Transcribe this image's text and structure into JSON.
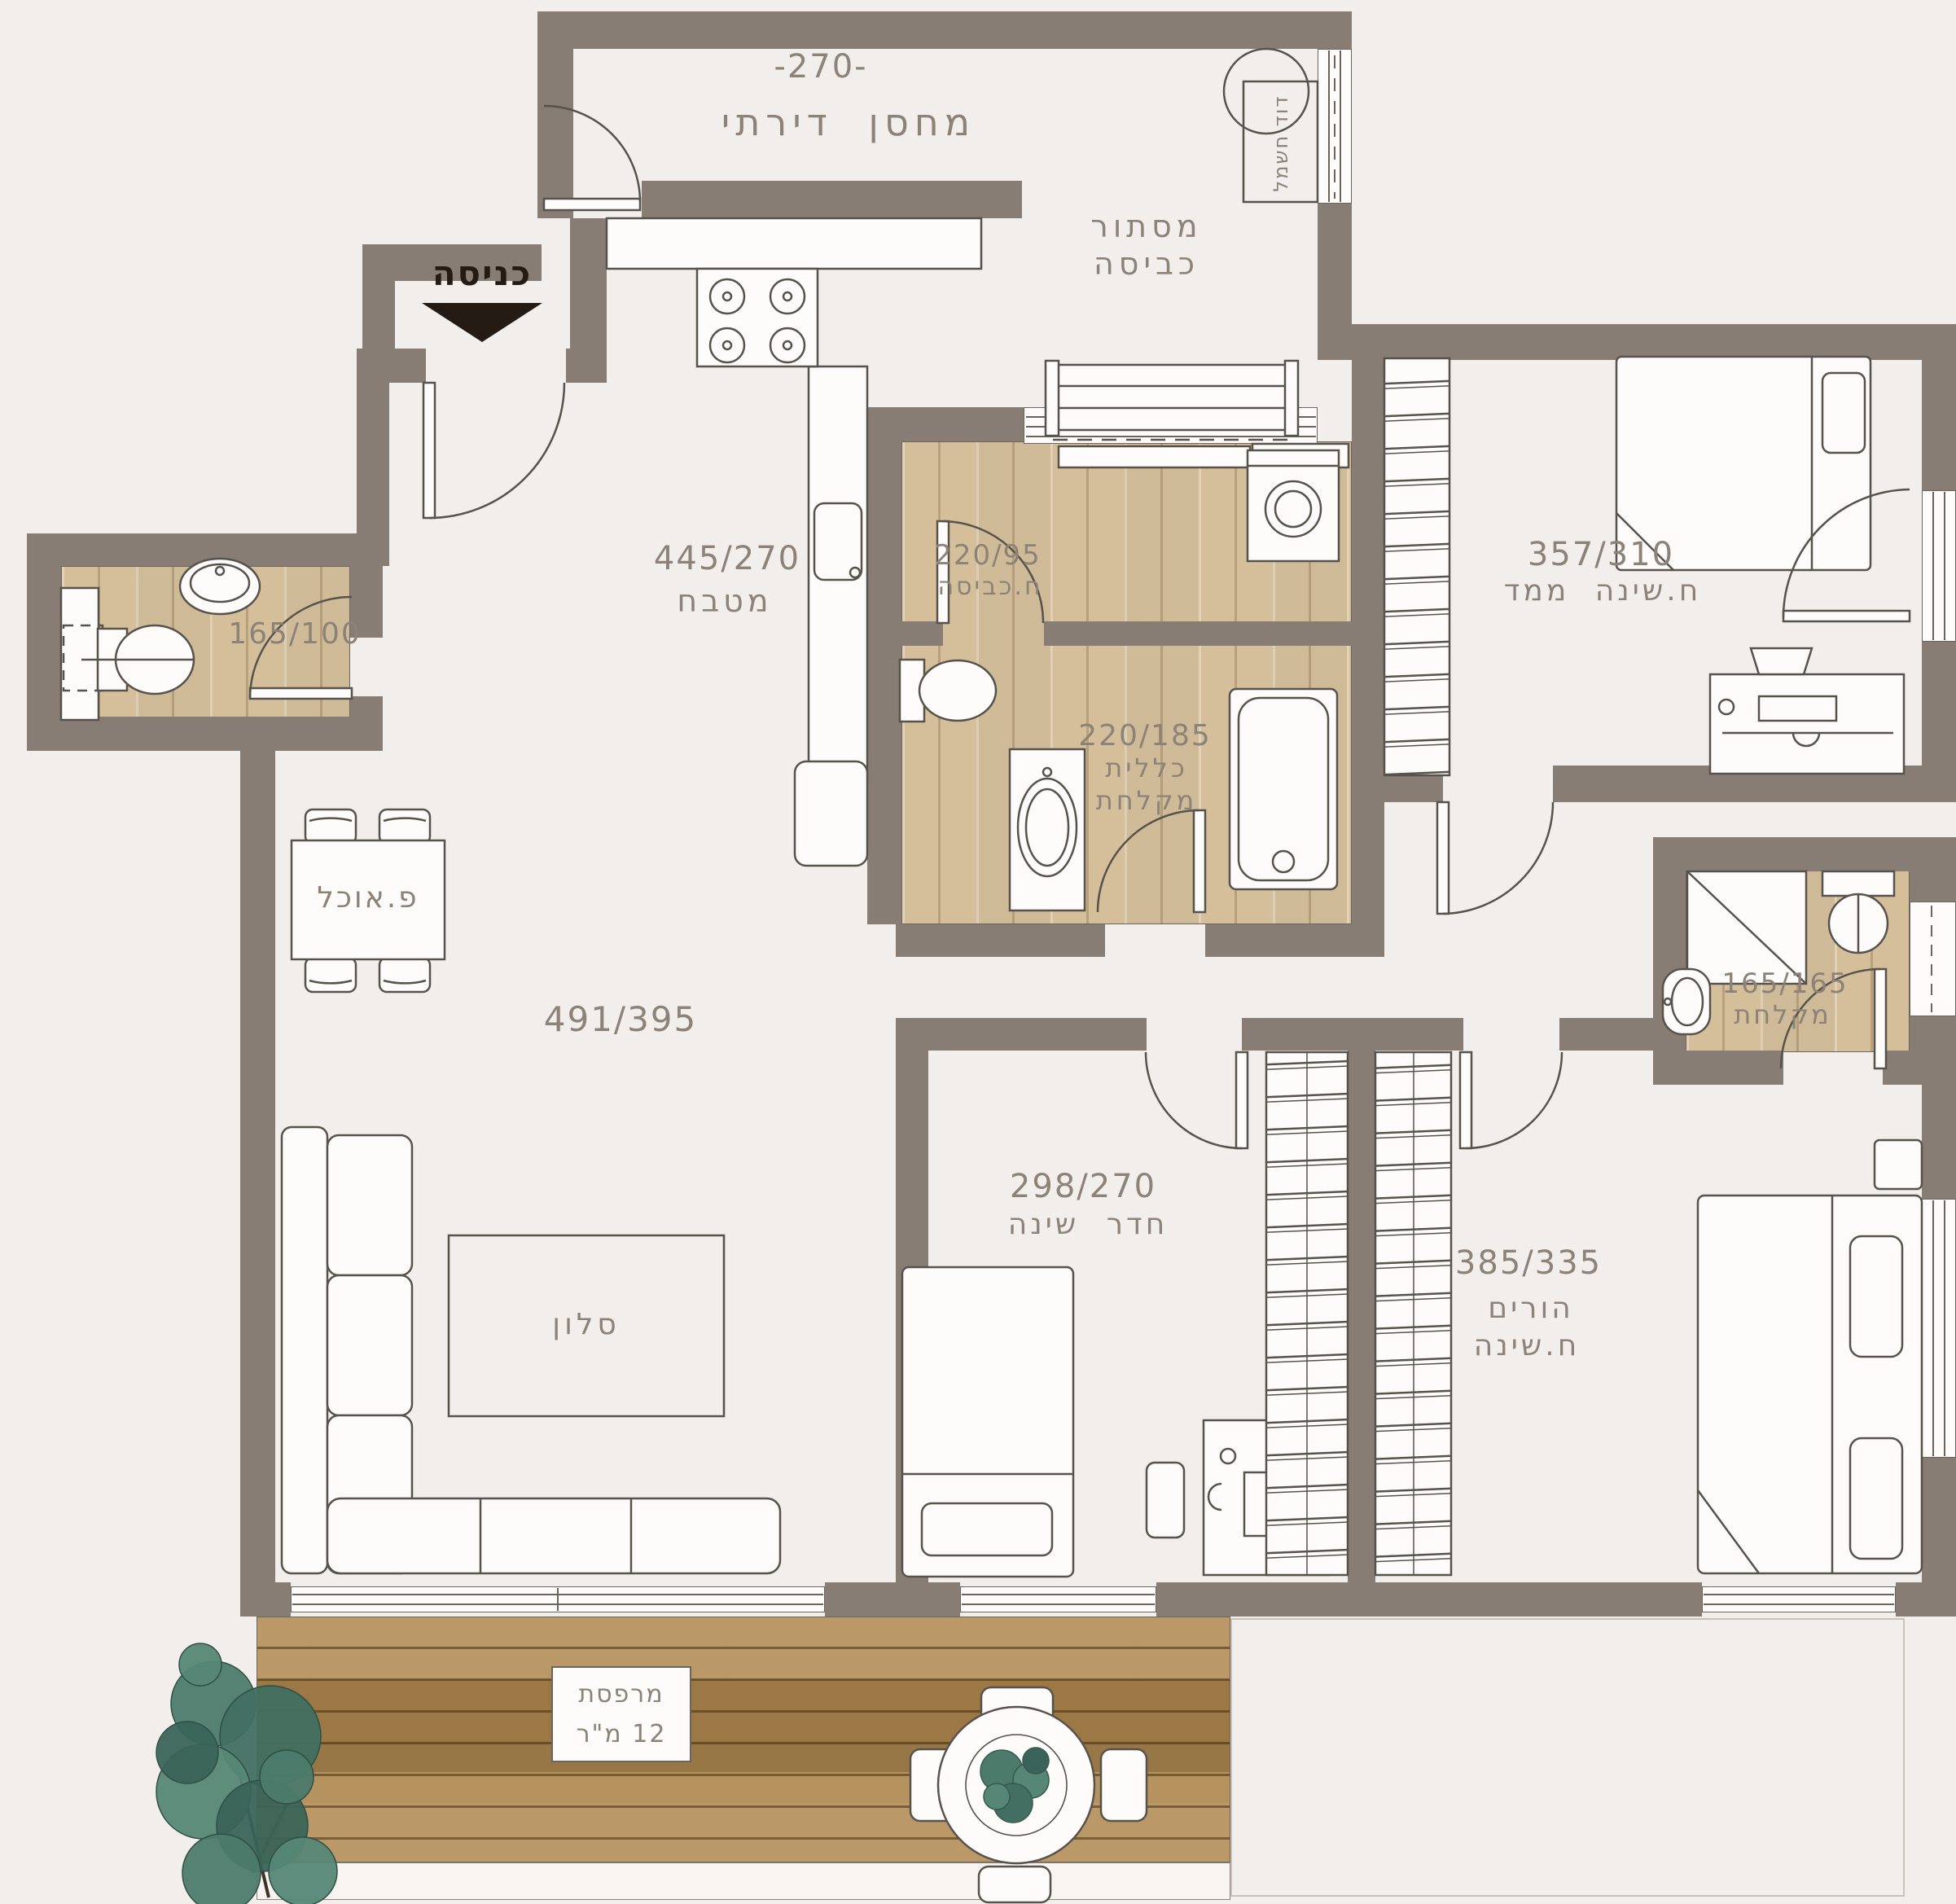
{
  "meta": {
    "type": "architectural floor plan",
    "language": "he"
  },
  "colors": {
    "background": "#f2eeeb",
    "wall": "#877d74",
    "wood_floor": "#dcc9a6",
    "deck_wood": "#b08a52",
    "outline": "#57524c",
    "label_text": "#8c8278",
    "entrance_text": "#241c14",
    "plant": "#4c7b6c",
    "fixture_fill": "#fdfcfa"
  },
  "entrance": {
    "label": "כניסה"
  },
  "rooms": {
    "storage": {
      "dim": "-270-",
      "name": "מחסן דירתי"
    },
    "laundry_concealment": {
      "name_line1": "מסתור",
      "name_line2": "כביסה"
    },
    "boiler_unit": {
      "label": "דוד חשמל"
    },
    "kitchen": {
      "dim": "445/270",
      "name": "מטבח"
    },
    "laundry_room": {
      "dim": "220/95",
      "name": "ח.כביסה"
    },
    "safe_bedroom": {
      "dim": "357/310",
      "name": "ח.שינה ממד"
    },
    "guest_toilet": {
      "dim": "165/100"
    },
    "bathroom": {
      "dim": "220/185",
      "name_line1": "כללית",
      "name_line2": "מקלחת"
    },
    "dining": {
      "name": "פ.אוכל"
    },
    "living": {
      "dim": "491/395",
      "name": "סלון"
    },
    "shower_room": {
      "dim": "165/165",
      "name": "מקלחת"
    },
    "bedroom": {
      "dim": "298/270",
      "name": "חדר שינה"
    },
    "master_bedroom": {
      "dim": "385/335",
      "name_line1": "הורים",
      "name_line2": "ח.שינה"
    },
    "balcony": {
      "name_line1": "מרפסת",
      "name_line2": "12 מ\"ר"
    }
  }
}
